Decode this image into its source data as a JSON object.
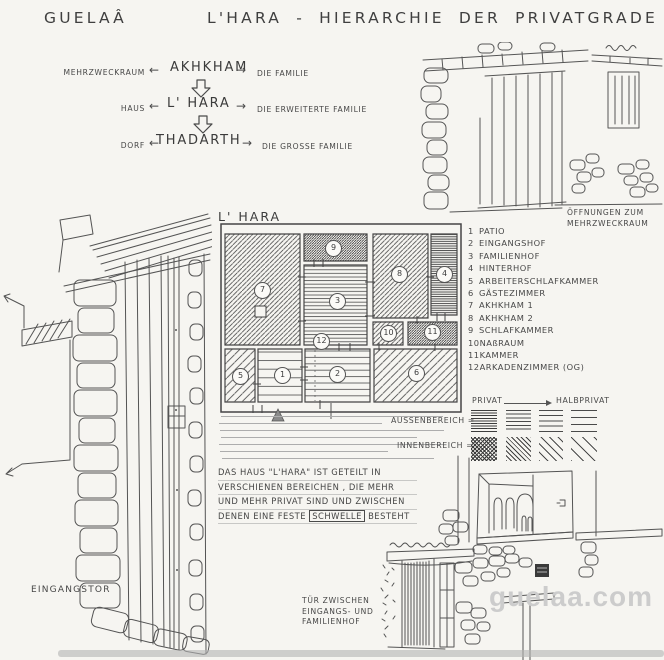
{
  "titles": {
    "left": "GUELAÂ",
    "right": "L'HARA - HIERARCHIE DER PRIVATGRADE"
  },
  "hierarchy": {
    "arrow_left": "←",
    "arrow_right": "→",
    "rows": [
      {
        "left": "MEHRZWECKRAUM",
        "term": "AKHKHAM",
        "right": "DIE FAMILIE"
      },
      {
        "left": "HAUS",
        "term": "L' HARA",
        "right": "DIE ERWEITERTE FAMILIE"
      },
      {
        "left": "DORF",
        "term": "THADARTH",
        "right": "DIE GROSSE FAMILIE"
      }
    ]
  },
  "plan": {
    "title": "L' HARA",
    "rooms": [
      {
        "num": "1",
        "label": "PATIO"
      },
      {
        "num": "2",
        "label": "EINGANGSHOF"
      },
      {
        "num": "3",
        "label": "FAMILIENHOF"
      },
      {
        "num": "4",
        "label": "HINTERHOF"
      },
      {
        "num": "5",
        "label": "ARBEITERSCHLAFKAMMER"
      },
      {
        "num": "6",
        "label": "GÄSTEZIMMER"
      },
      {
        "num": "7",
        "label": "AKHKHAM 1"
      },
      {
        "num": "8",
        "label": "AKHKHAM 2"
      },
      {
        "num": "9",
        "label": "SCHLAFKAMMER"
      },
      {
        "num": "10",
        "label": "NAßRAUM"
      },
      {
        "num": "11",
        "label": "KAMMER"
      },
      {
        "num": "12",
        "label": "ARKADENZIMMER (OG)"
      }
    ]
  },
  "privacy_legend": {
    "privat": "PRIVAT",
    "halbprivat": "HALBPRIVAT",
    "aussenbereich": "AUSSENBEREICH =",
    "innenbereich": "INNENBEREICH ="
  },
  "paragraph": {
    "line1": "DAS HAUS \"L'HARA\" IST GETEILT IN",
    "line2": "VERSCHIENEN BEREICHEN , DIE MEHR",
    "line3": "UND MEHR PRIVAT SIND UND ZWISCHEN",
    "line4_pre": "DENEN EINE FESTE",
    "line4_boxed": "SCHWELLE",
    "line4_post": "BESTEHT"
  },
  "captions": {
    "openings_line1": "ÖFFNUNGEN ZUM",
    "openings_line2": "MEHRZWECKRAUM",
    "entrance_gate": "EINGANGSTOR",
    "door_line1": "TÜR ZWISCHEN",
    "door_line2": "EINGANGS- UND",
    "door_line3": "FAMILIENHOF"
  },
  "watermark": "guelaa.com",
  "colors": {
    "paper": "#f6f5f1",
    "ink": "#4a4a4a",
    "pencil_line": "#adadad",
    "watermark": "#cccccc"
  }
}
